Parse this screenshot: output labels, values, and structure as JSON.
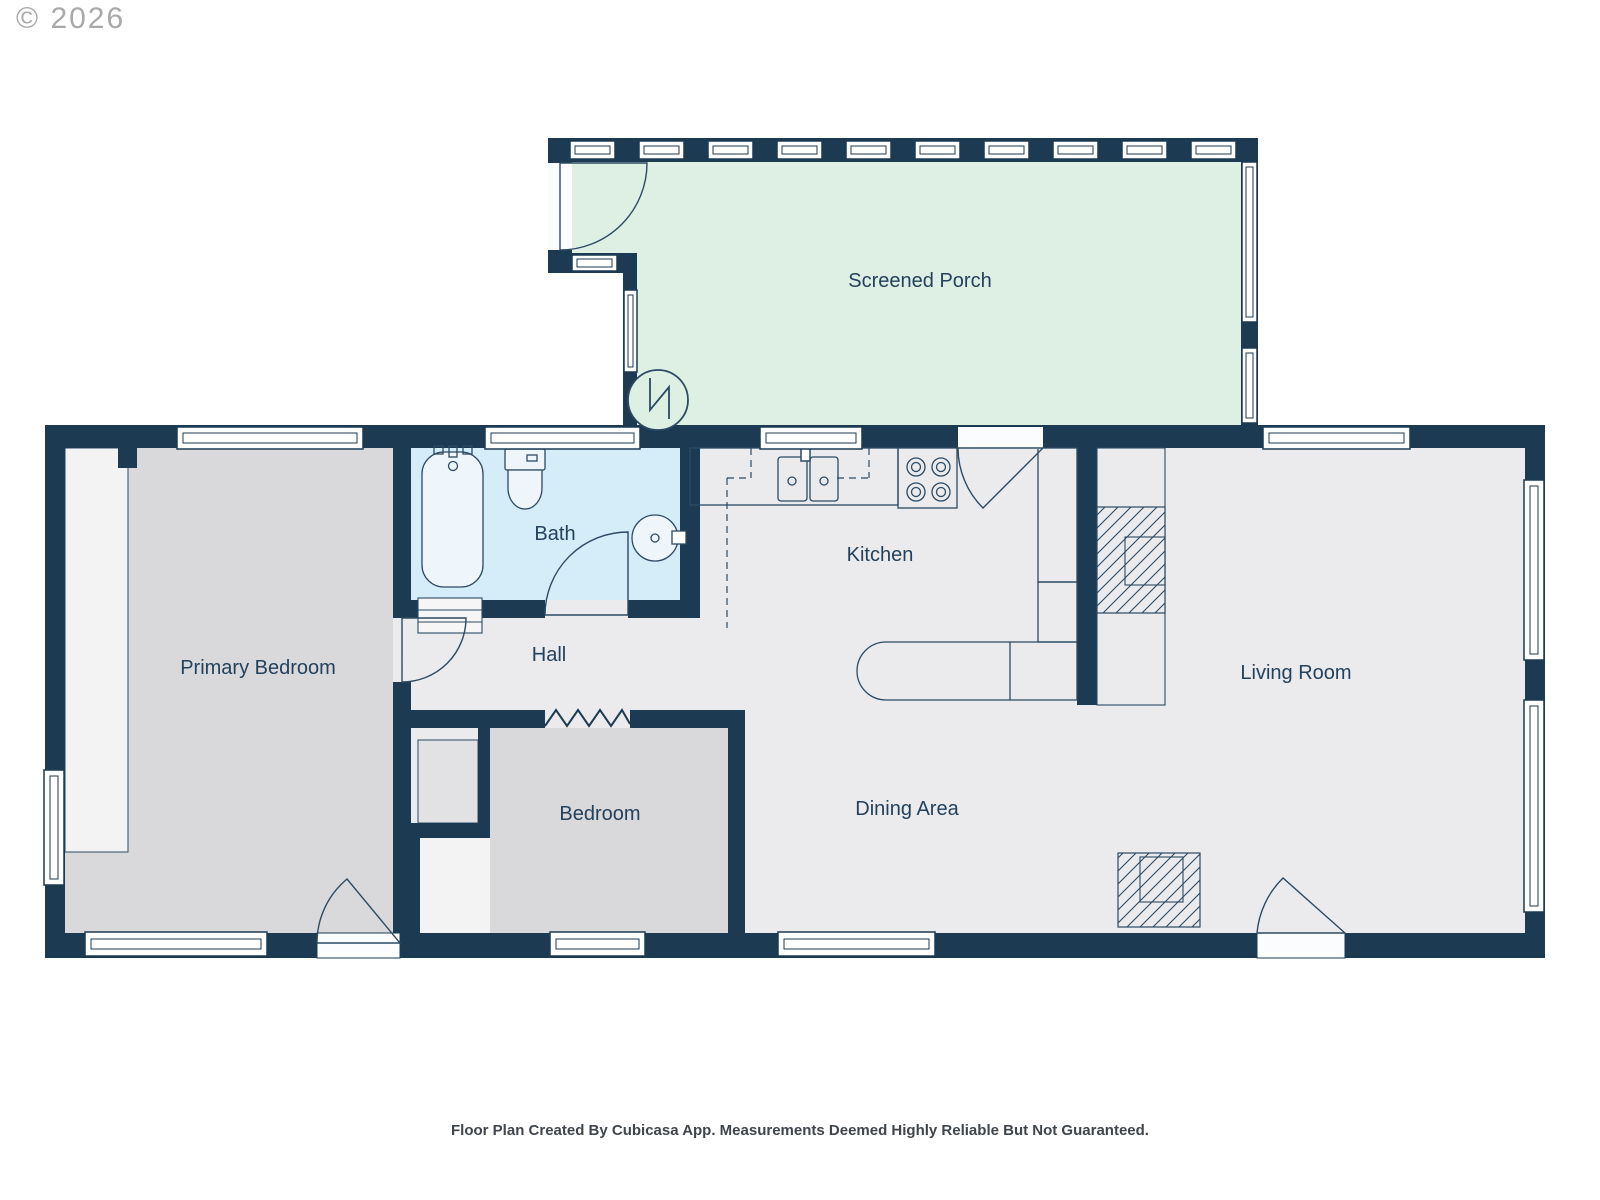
{
  "page": {
    "copyright": "© 2026",
    "footer": "Floor Plan Created By Cubicasa App. Measurements Deemed Highly Reliable But Not Guaranteed."
  },
  "rooms": {
    "screened_porch": "Screened Porch",
    "bath": "Bath",
    "kitchen": "Kitchen",
    "hall": "Hall",
    "primary_bedroom": "Primary Bedroom",
    "living_room": "Living Room",
    "bedroom": "Bedroom",
    "dining_area": "Dining Area"
  },
  "colors": {
    "wall": "#1c3a52",
    "floor": "#ebebed",
    "bedroom_floor": "#d9d9db",
    "closet": "#f3f3f4",
    "bath_floor": "#d5ecf9",
    "porch_floor": "#def0e4",
    "label_text": "#23415c",
    "footer_text": "#3f454b",
    "copyright_text": "#a9a9a9"
  },
  "icons": [
    "window",
    "door",
    "bathtub",
    "toilet",
    "bathroom-sink",
    "kitchen-sink",
    "stove",
    "refrigerator",
    "kitchen-island",
    "fireplace",
    "floor-register",
    "water-heater",
    "wall-opening-zigzag"
  ]
}
